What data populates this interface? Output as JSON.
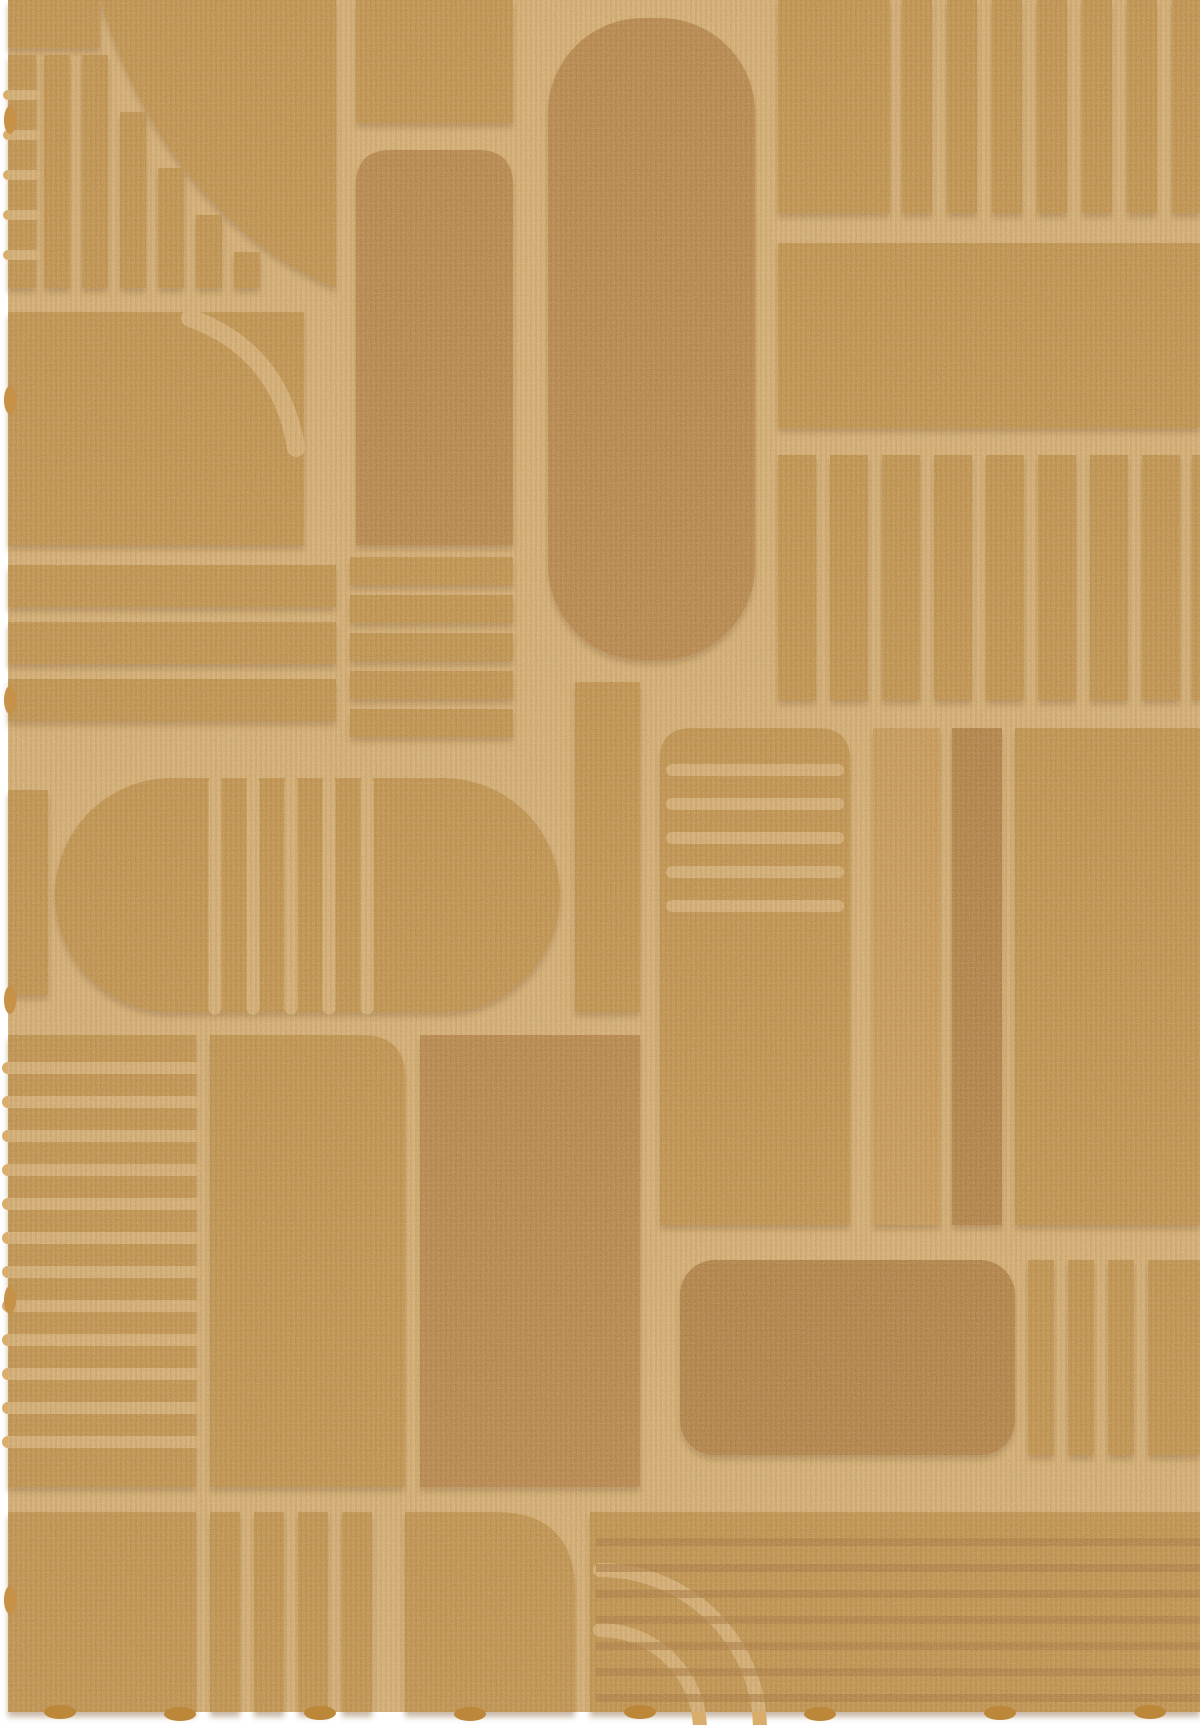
{
  "image": {
    "kind": "product-photo",
    "subject": "Carved-pile wool rug in mustard ochre with an art-deco geometric relief pattern",
    "alt": "Top-down photograph of a rectangular mustard-gold rug whose high-low carved pile forms arches, a large oval capsule, quarter-circle arcs and groups of vertical and horizontal bars",
    "orientation": "portrait"
  },
  "colors": {
    "page-bg": "#ffffff",
    "groove": "#d9ad6c",
    "pile": "#bd8739",
    "pile-dark": "#b17734",
    "pile-deep": "#a96f2e",
    "pile-light": "#c79147",
    "rib-dark": "#a2682a",
    "shadow": "#6f4413"
  },
  "pattern": {
    "style": "art-deco carved relief",
    "motifs": [
      "striped fan under quarter arc (top left)",
      "tall round-top arch (top centre)",
      "large capsule oval (centre)",
      "vertical bar groups (top right)",
      "plain horizontal band (right)",
      "striped capsule pill (middle left)",
      "ribbed round-corner block (middle right)",
      "horizontal rib block (bottom left)",
      "quarter-round arch (bottom centre)",
      "concentric corner arcs over ribbed band (bottom right)"
    ]
  }
}
